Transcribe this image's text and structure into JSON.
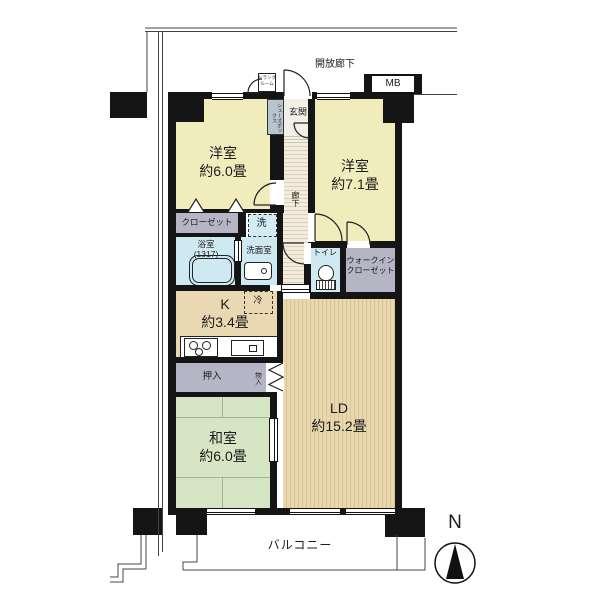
{
  "plan": {
    "open_corridor": "開放廊下",
    "meter_box": "MB",
    "trunk1": "トランク",
    "trunk2": "ルーム",
    "entrance": "玄関",
    "shoe_box": "シューズボックス",
    "hallway": "廊下",
    "balcony": "バルコニー",
    "compass_north": "N",
    "rooms": {
      "western1": {
        "name": "洋室",
        "size": "約6.0畳"
      },
      "western2": {
        "name": "洋室",
        "size": "約7.1畳"
      },
      "japanese": {
        "name": "和室",
        "size": "約6.0畳"
      },
      "living_dining": {
        "name": "LD",
        "size": "約15.2畳"
      },
      "kitchen": {
        "name": "K",
        "size": "約3.4畳"
      }
    },
    "storage": {
      "closet": "クローゼット",
      "walk_in_closet1": "ウォークイン",
      "walk_in_closet2": "クローゼット",
      "oshiire": "押入",
      "storage_small": "物入"
    },
    "wet": {
      "bath1": "浴室",
      "bath2": "(1317)",
      "washroom": "洗面室",
      "washer": "洗",
      "toilet": "トイレ",
      "fridge": "冷"
    },
    "colors": {
      "western_room": "#f0ecbc",
      "japanese_room": "#d6e6c4",
      "wood_floor": "#e9d7b0",
      "wet_area": "#cfe9f2",
      "closet_gray": "#b5b5c5",
      "wall": "#151515"
    }
  }
}
